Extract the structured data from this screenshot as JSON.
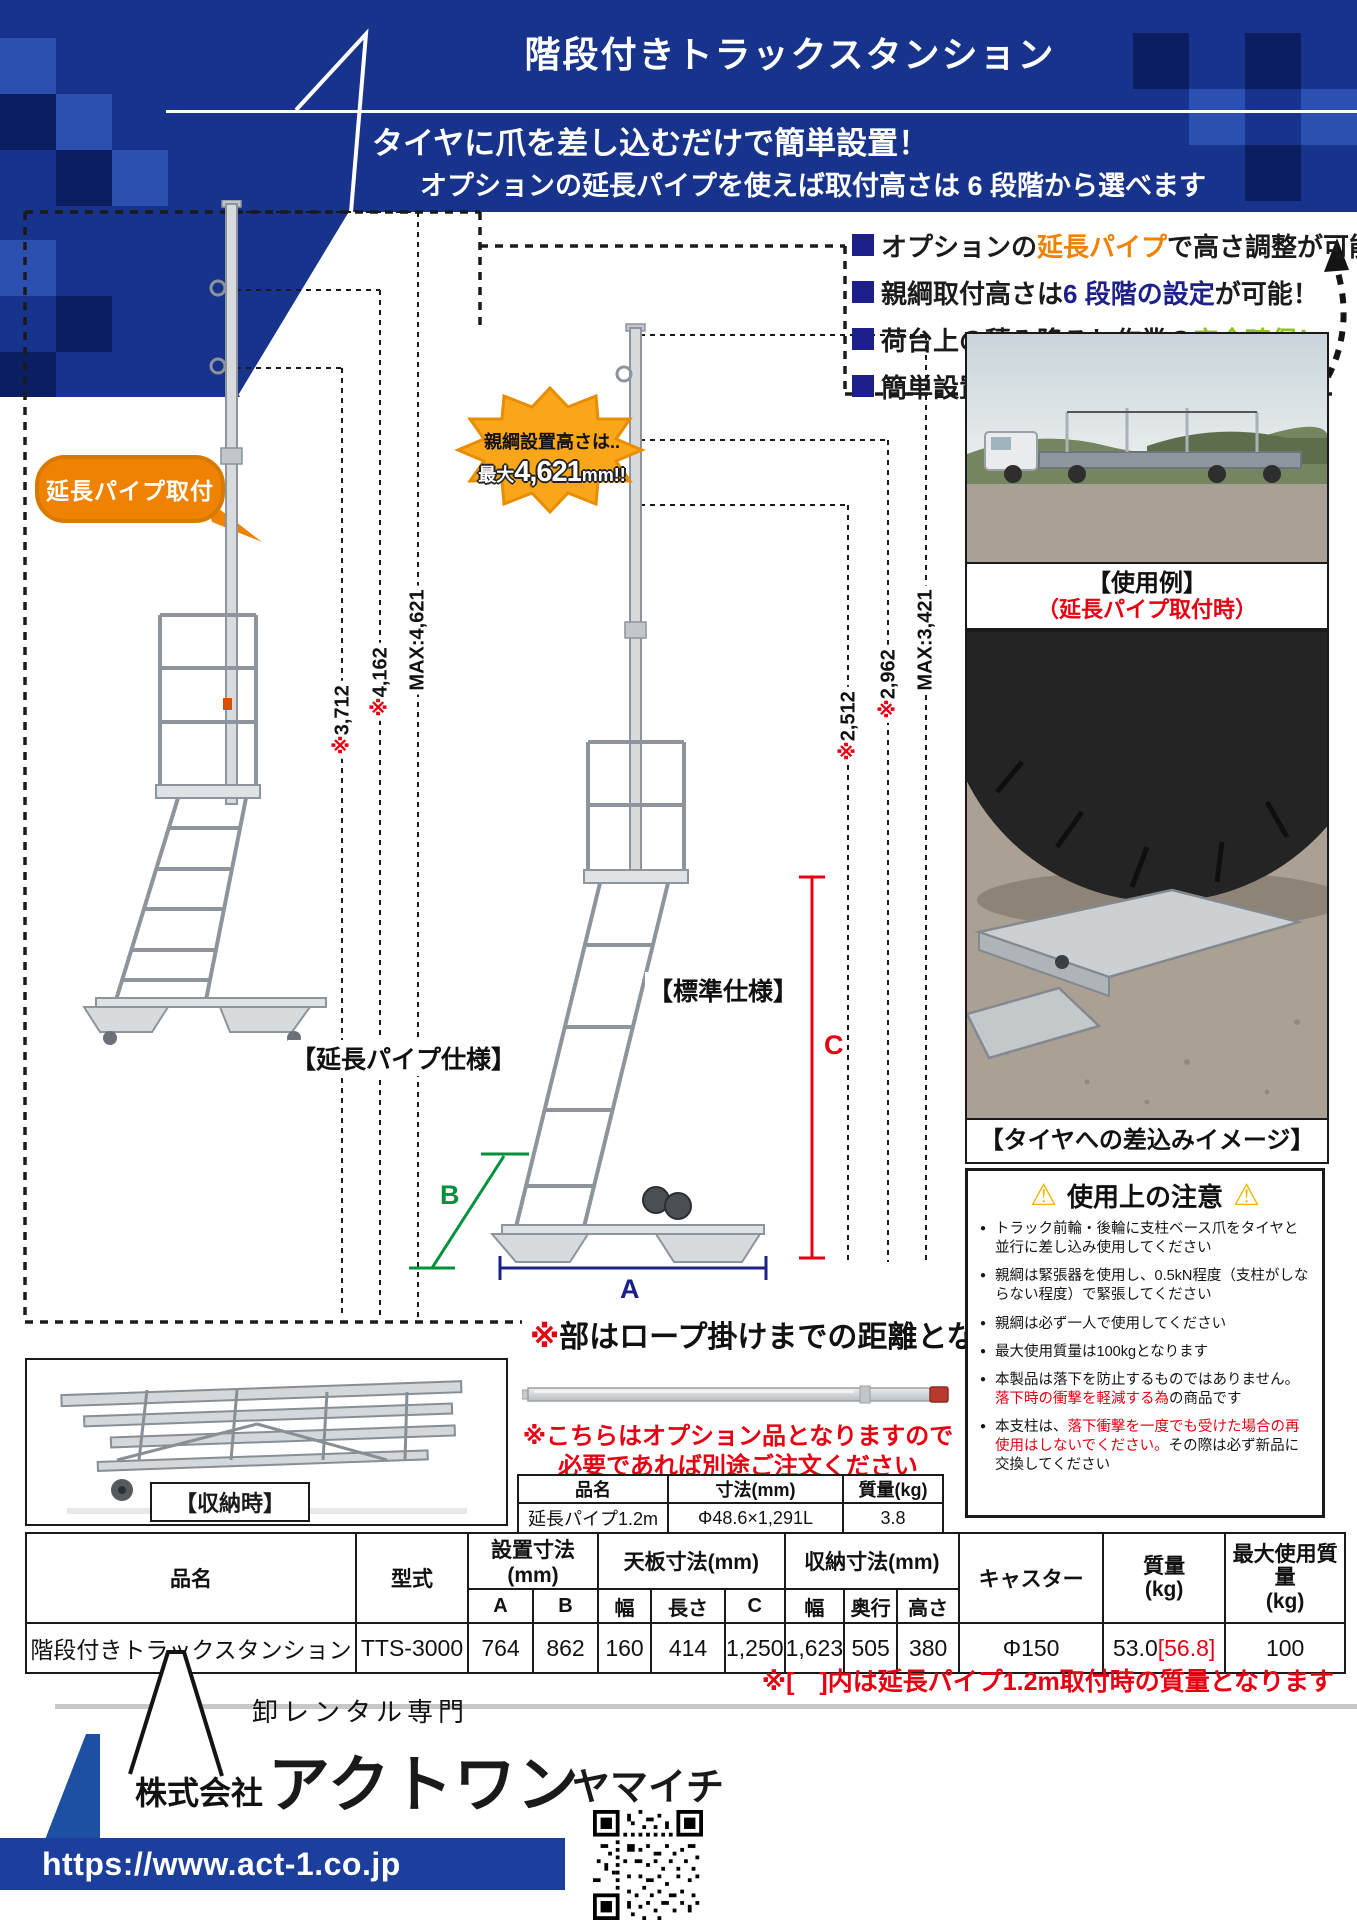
{
  "colors": {
    "header_blue": "#17338c",
    "accent_orange": "#ef8200",
    "accent_blue": "#1d2088",
    "accent_green": "#8fc31f",
    "accent_cyan": "#00a0e9",
    "red": "#e60012",
    "dim_green": "#00913a",
    "burst_orange": "#f9a61a",
    "url_bar_blue": "#1c3e9c"
  },
  "header": {
    "title": "階段付きトラックスタンション",
    "subtitle1": "タイヤに爪を差し込むだけで簡単設置！",
    "subtitle2": "オプションの延長パイプを使えば取付高さは 6 段階から選べます"
  },
  "features": [
    {
      "pre": "オプションの",
      "hl": "延長パイプ",
      "post": "で高さ調整が可能！"
    },
    {
      "pre": "親綱取付高さは ",
      "hl": "6 段階の設定",
      "post": "が可能！"
    },
    {
      "pre": "荷台上の積み降ろし作業の",
      "hl": "安全確保！",
      "post": ""
    },
    {
      "pre": "簡単設置で作業効率が",
      "hl": "大幅に向上！",
      "post": ""
    }
  ],
  "burst": {
    "line1": "親綱設置高さは..",
    "l2_prefix": "最大",
    "l2_value": "4,621",
    "l2_unit": "mm!!"
  },
  "bubble": {
    "label": "延長パイプ取付"
  },
  "dims": {
    "left": [
      {
        "star": "",
        "text": "MAX:4,621"
      },
      {
        "star": "※",
        "text": "4,162"
      },
      {
        "star": "※",
        "text": "3,712"
      }
    ],
    "right": [
      {
        "star": "",
        "text": "MAX:3,421"
      },
      {
        "star": "※",
        "text": "2,962"
      },
      {
        "star": "※",
        "text": "2,512"
      }
    ],
    "letters": {
      "a": "A",
      "b": "B",
      "c": "C"
    }
  },
  "captions": {
    "extended": "【延長パイプ仕様】",
    "standard": "【標準仕様】",
    "storage": "【収納時】",
    "usage_1": "【使用例】",
    "usage_2": "（延長パイプ取付時）",
    "tire": "【タイヤへの差込みイメージ】"
  },
  "rope_note": {
    "star": "※",
    "text": "部はロープ掛けまでの距離となります"
  },
  "option": {
    "note1": "※こちらはオプション品となりますので",
    "note2": "必要であれば別途ご注文ください",
    "headers": [
      "品名",
      "寸法(mm)",
      "質量(kg)"
    ],
    "row": [
      "延長パイプ1.2m",
      "Φ48.6×1,291L",
      "3.8"
    ]
  },
  "warning": {
    "icon": "⚠",
    "title": "使用上の注意",
    "items": [
      {
        "pre": "トラック前輪・後輪に支柱ベース爪をタイヤと並行に差し込み使用してください",
        "red": "",
        "post": ""
      },
      {
        "pre": "親綱は緊張器を使用し、0.5kN程度（支柱がしならない程度）で緊張してください",
        "red": "",
        "post": ""
      },
      {
        "pre": "親綱は必ず一人で使用してください",
        "red": "",
        "post": ""
      },
      {
        "pre": "最大使用質量は100kgとなります",
        "red": "",
        "post": ""
      },
      {
        "pre": "本製品は落下を防止するものではありません。",
        "red": "落下時の衝撃を軽減する為",
        "post": "の商品です"
      },
      {
        "pre": "本支柱は、",
        "red": "落下衝撃を一度でも受けた場合の再使用はしないでください。",
        "post": "その際は必ず新品に交換してください"
      }
    ]
  },
  "spec_table": {
    "h_name": "品名",
    "h_model": "型式",
    "h_install": "設置寸法(mm)",
    "h_top": "天板寸法(mm)",
    "h_storage": "収納寸法(mm)",
    "h_caster": "キャスター",
    "h_weight1": "質量",
    "h_weight2": "(kg)",
    "h_max1": "最大使用質量",
    "h_max2": "(kg)",
    "sub": {
      "a": "A",
      "b": "B",
      "w1": "幅",
      "l1": "長さ",
      "c": "C",
      "w2": "幅",
      "d2": "奥行",
      "h2": "高さ"
    },
    "row": {
      "name": "階段付きトラックスタンション",
      "model": "TTS-3000",
      "a": "764",
      "b": "862",
      "w1": "160",
      "l1": "414",
      "c": "1,250",
      "w2": "1,623",
      "d2": "505",
      "h2": "380",
      "caster": "Φ150",
      "weight": "53.0",
      "weight_bracket": "[56.8]",
      "max": "100"
    }
  },
  "spec_note": "※[　]内は延長パイプ1.2m取付時の質量となります",
  "footer": {
    "tagline": "卸レンタル専門",
    "prefix": "株式会社",
    "name": "アクトワン",
    "suffix": "ヤマイチ",
    "url": "https://www.act-1.co.jp"
  }
}
